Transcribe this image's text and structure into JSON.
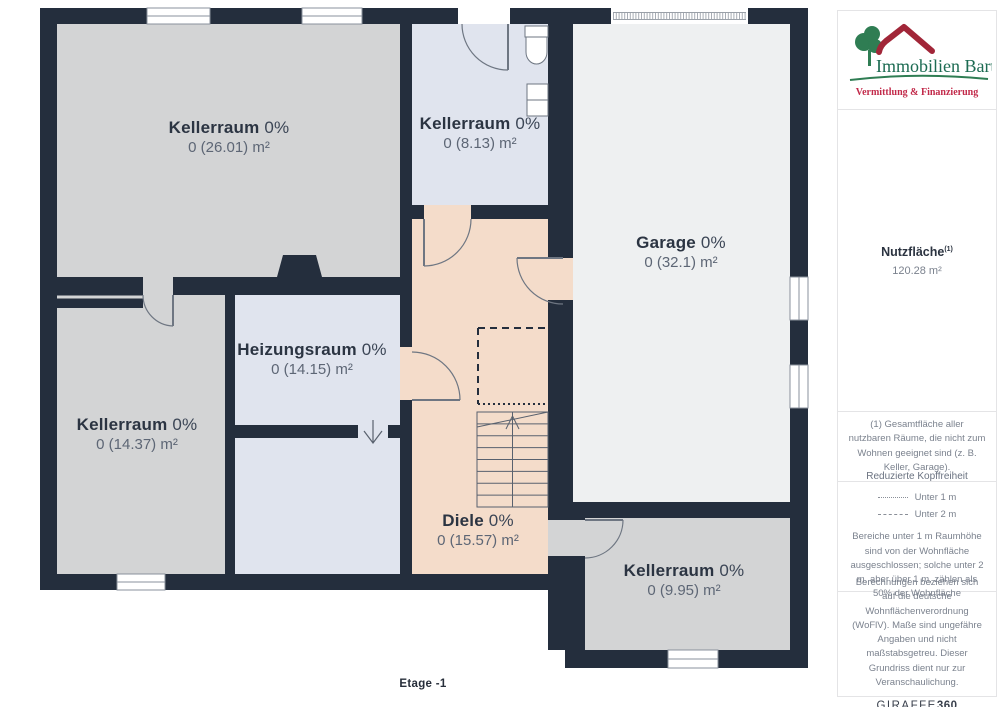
{
  "floor_label": "Etage -1",
  "rooms": [
    {
      "name": "Kellerraum",
      "pct": "0%",
      "area": "0 (26.01) m²"
    },
    {
      "name": "Kellerraum",
      "pct": "0%",
      "area": "0 (8.13) m²"
    },
    {
      "name": "Garage",
      "pct": "0%",
      "area": "0 (32.1) m²"
    },
    {
      "name": "Heizungsraum",
      "pct": "0%",
      "area": "0 (14.15) m²"
    },
    {
      "name": "Kellerraum",
      "pct": "0%",
      "area": "0 (14.37) m²"
    },
    {
      "name": "Diele",
      "pct": "0%",
      "area": "0 (15.57) m²"
    },
    {
      "name": "Kellerraum",
      "pct": "0%",
      "area": "0 (9.95) m²"
    }
  ],
  "sidebar": {
    "logo": {
      "name": "Immobilien Bart",
      "tagline": "Vermittlung & Finanzierung"
    },
    "nutzflaeche": {
      "label": "Nutzfläche",
      "sup": "(1)",
      "value": "120.28 m²"
    },
    "footnote": "(1) Gesamtfläche aller nutzbaren Räume, die nicht zum Wohnen geeignet sind (z. B. Keller, Garage).",
    "legend": {
      "title": "Reduzierte Kopffreiheit",
      "items": [
        {
          "style": "dotted",
          "label": "Unter 1 m"
        },
        {
          "style": "dashed",
          "label": "Unter 2 m"
        }
      ],
      "note": "Bereiche unter 1 m Raumhöhe sind von der Wohnfläche ausgeschlossen; solche unter 2 m, aber über 1 m, zählen als 50% der Wohnfläche"
    },
    "disclaimer": "Berechnungen beziehen sich auf die deutsche Wohnflächenverordnung (WoFlV). Maße sind ungefähre Angaben und nicht maßstabsgetreu. Dieser Grundriss dient nur zur Veranschaulichung.",
    "brand": {
      "giraffe": "GIRAFFE",
      "threesixty": "360"
    }
  },
  "colors": {
    "wall": "#242e3d",
    "room_gray": "#d3d4d5",
    "room_blue": "#e0e4ee",
    "room_garage": "#eef0f1",
    "room_peach": "#f4dcca",
    "logo_green": "#1c6b52",
    "logo_red": "#a12638",
    "tagline_red": "#c22a4a",
    "text_dark": "#2b3442",
    "text_gray": "#7b828e"
  }
}
